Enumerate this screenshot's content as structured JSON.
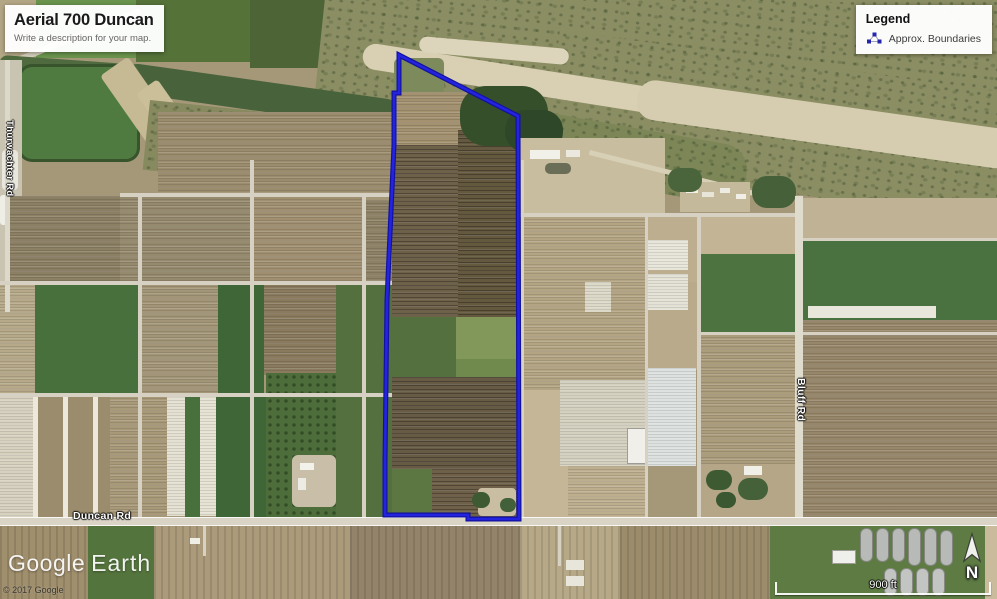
{
  "title_card": {
    "title": "Aerial 700 Duncan",
    "subtitle": "Write a description for your map."
  },
  "legend": {
    "title": "Legend",
    "items": [
      {
        "label": "Approx. Boundaries",
        "icon": "polygon-vertices-icon",
        "icon_color": "#2525ad"
      }
    ]
  },
  "road_labels": [
    {
      "name": "Duncan Rd",
      "orientation": "horizontal"
    },
    {
      "name": "Bluff Rd",
      "orientation": "vertical"
    },
    {
      "name": "Thurwachter Rd",
      "orientation": "vertical"
    }
  ],
  "watermark": {
    "part1": "Google",
    "part2": "Earth"
  },
  "copyright": "© 2017 Google",
  "compass": {
    "label": "N"
  },
  "scale_bar": {
    "label": "900 ft"
  },
  "boundary": {
    "label": "Approx. Boundaries",
    "color_outer": "#12129e",
    "color_inner": "#2424e0",
    "stroke_width_outer": 5,
    "stroke_width_inner": 2.6,
    "path": "M399,55 L518,116 L519,519 L468,519 L468,515 L385,515 L385,462 L387,300 L394,145 L394,93 L399,93 Z"
  },
  "map": {
    "patches": [
      {
        "x": 0,
        "y": 0,
        "w": 997,
        "h": 599,
        "c": "#a59878"
      },
      {
        "x": 0,
        "y": 0,
        "w": 42,
        "h": 64,
        "c": "#b3a685"
      },
      {
        "x": 36,
        "y": 0,
        "w": 100,
        "h": 58,
        "c": "#6a944e"
      },
      {
        "x": 136,
        "y": 0,
        "w": 116,
        "h": 62,
        "c": "#557239"
      },
      {
        "x": 250,
        "y": 0,
        "w": 115,
        "h": 68,
        "c": "#4d6437"
      },
      {
        "x": 0,
        "y": 64,
        "w": 150,
        "h": 6,
        "c": "#d5cfbd",
        "r": -22
      },
      {
        "x": 330,
        "y": -10,
        "w": 680,
        "h": 75,
        "c": "#8b8d63",
        "t": "speckle"
      },
      {
        "x": 330,
        "y": -50,
        "w": 700,
        "h": 150,
        "c": "#8b8d63",
        "t": "speckle",
        "r": 6
      },
      {
        "x": 560,
        "y": 30,
        "w": 470,
        "h": 130,
        "c": "#8b8d63",
        "t": "speckle",
        "r": 8
      },
      {
        "x": 365,
        "y": 42,
        "w": 320,
        "h": 26,
        "c": "#d9d0b4",
        "r": 9,
        "br": 13
      },
      {
        "x": 640,
        "y": 78,
        "w": 380,
        "h": 40,
        "c": "#d6cdb1",
        "r": 8,
        "br": 18
      },
      {
        "x": 420,
        "y": 36,
        "w": 150,
        "h": 16,
        "c": "#ddd5bb",
        "r": 5,
        "br": 8
      },
      {
        "x": 505,
        "y": 105,
        "w": 250,
        "h": 60,
        "c": "#7c8657",
        "t": "speckle",
        "r": 10,
        "br": 26
      },
      {
        "x": 125,
        "y": 62,
        "w": 280,
        "h": 30,
        "c": "#48633b",
        "r": 8,
        "br": 15
      },
      {
        "x": 0,
        "y": 55,
        "w": 140,
        "h": 16,
        "c": "#4e6a3e",
        "r": 4,
        "br": 8
      },
      {
        "x": 18,
        "y": 64,
        "w": 122,
        "h": 98,
        "c": "#4f7a40",
        "t": "edge",
        "br": 14
      },
      {
        "x": 100,
        "y": 76,
        "w": 34,
        "h": 96,
        "c": "#c6ba94",
        "r": -35,
        "br": 4
      },
      {
        "x": 136,
        "y": 94,
        "w": 26,
        "h": 80,
        "c": "#cbbf9a",
        "r": -35,
        "br": 4
      },
      {
        "x": 150,
        "y": 100,
        "w": 110,
        "h": 70,
        "c": "#87895f",
        "t": "speckle",
        "r": 6
      },
      {
        "x": 0,
        "y": 60,
        "w": 22,
        "h": 250,
        "c": "#c9c3b2"
      },
      {
        "x": 2,
        "y": 150,
        "w": 16,
        "h": 40,
        "c": "#e9e7dd",
        "br": 4
      },
      {
        "x": 0,
        "y": 195,
        "w": 14,
        "h": 30,
        "c": "#efeee6",
        "br": 3
      },
      {
        "x": 158,
        "y": 112,
        "w": 234,
        "h": 84,
        "c": "#9b8c6d",
        "t": "rows"
      },
      {
        "x": 6,
        "y": 196,
        "w": 114,
        "h": 87,
        "c": "#8b7f64",
        "t": "rows"
      },
      {
        "x": 120,
        "y": 196,
        "w": 132,
        "h": 87,
        "c": "#968a6e",
        "t": "rows"
      },
      {
        "x": 252,
        "y": 196,
        "w": 112,
        "h": 87,
        "c": "#a09071",
        "t": "rows"
      },
      {
        "x": 364,
        "y": 200,
        "w": 28,
        "h": 83,
        "c": "#8d8266",
        "t": "rows"
      },
      {
        "x": 0,
        "y": 283,
        "w": 35,
        "h": 112,
        "c": "#b5a989",
        "t": "rows"
      },
      {
        "x": 35,
        "y": 283,
        "w": 105,
        "h": 112,
        "c": "#47703c"
      },
      {
        "x": 140,
        "y": 283,
        "w": 78,
        "h": 112,
        "c": "#a39577",
        "t": "rows"
      },
      {
        "x": 218,
        "y": 283,
        "w": 46,
        "h": 112,
        "c": "#3f6636"
      },
      {
        "x": 264,
        "y": 283,
        "w": 72,
        "h": 92,
        "c": "#8a7b5f",
        "t": "rows"
      },
      {
        "x": 336,
        "y": 283,
        "w": 56,
        "h": 235,
        "c": "#54703e"
      },
      {
        "x": 0,
        "y": 395,
        "w": 33,
        "h": 123,
        "c": "#d7d1bf",
        "t": "rows"
      },
      {
        "x": 33,
        "y": 395,
        "w": 77,
        "h": 123,
        "c": "#9a8c6d",
        "t": "strips"
      },
      {
        "x": 110,
        "y": 395,
        "w": 57,
        "h": 123,
        "c": "#a89979",
        "t": "rows"
      },
      {
        "x": 167,
        "y": 397,
        "w": 18,
        "h": 119,
        "c": "#e4e1d2",
        "t": "rows"
      },
      {
        "x": 185,
        "y": 395,
        "w": 15,
        "h": 123,
        "c": "#47703c"
      },
      {
        "x": 200,
        "y": 397,
        "w": 16,
        "h": 119,
        "c": "#e6e3d4",
        "t": "rows"
      },
      {
        "x": 216,
        "y": 395,
        "w": 50,
        "h": 123,
        "c": "#3f6636"
      },
      {
        "x": 266,
        "y": 373,
        "w": 70,
        "h": 145,
        "c": "#4d6d3b",
        "t": "dots"
      },
      {
        "x": 292,
        "y": 455,
        "w": 44,
        "h": 52,
        "c": "#c9bfa8",
        "br": 6
      },
      {
        "x": 300,
        "y": 463,
        "w": 14,
        "h": 7,
        "c": "#f2f1ea"
      },
      {
        "x": 298,
        "y": 478,
        "w": 8,
        "h": 12,
        "c": "#ecece4"
      },
      {
        "x": 394,
        "y": 58,
        "w": 50,
        "h": 36,
        "c": "#7d8a5c",
        "br": 6
      },
      {
        "x": 392,
        "y": 92,
        "w": 128,
        "h": 60,
        "c": "#a3916f",
        "t": "rows"
      },
      {
        "x": 392,
        "y": 145,
        "w": 128,
        "h": 172,
        "c": "#6e614a",
        "t": "rows-dark"
      },
      {
        "x": 458,
        "y": 130,
        "w": 62,
        "h": 187,
        "c": "#64583f",
        "t": "rows-dark"
      },
      {
        "x": 392,
        "y": 317,
        "w": 64,
        "h": 60,
        "c": "#55703f"
      },
      {
        "x": 456,
        "y": 317,
        "w": 64,
        "h": 42,
        "c": "#81985a"
      },
      {
        "x": 456,
        "y": 359,
        "w": 64,
        "h": 18,
        "c": "#6f8a4c"
      },
      {
        "x": 392,
        "y": 377,
        "w": 128,
        "h": 92,
        "c": "#675b45",
        "t": "rows-dark"
      },
      {
        "x": 392,
        "y": 469,
        "w": 40,
        "h": 49,
        "c": "#5d7742"
      },
      {
        "x": 432,
        "y": 469,
        "w": 88,
        "h": 49,
        "c": "#6f6149",
        "t": "rows-dark"
      },
      {
        "x": 478,
        "y": 488,
        "w": 38,
        "h": 28,
        "c": "#c9bda2",
        "br": 4
      },
      {
        "x": 472,
        "y": 492,
        "w": 18,
        "h": 16,
        "c": "#3d5a33",
        "br": 8
      },
      {
        "x": 500,
        "y": 498,
        "w": 16,
        "h": 14,
        "c": "#42603a",
        "br": 7
      },
      {
        "x": 460,
        "y": 86,
        "w": 88,
        "h": 60,
        "c": "#364f2b",
        "br": 26
      },
      {
        "x": 505,
        "y": 110,
        "w": 58,
        "h": 42,
        "c": "#2f4729",
        "br": 20
      },
      {
        "x": 520,
        "y": 138,
        "w": 145,
        "h": 78,
        "c": "#c9bda0"
      },
      {
        "x": 530,
        "y": 150,
        "w": 30,
        "h": 9,
        "c": "#f1f0e9"
      },
      {
        "x": 545,
        "y": 163,
        "w": 26,
        "h": 11,
        "c": "#6b6e57",
        "br": 5
      },
      {
        "x": 566,
        "y": 150,
        "w": 14,
        "h": 7,
        "c": "#ebe9df"
      },
      {
        "x": 590,
        "y": 150,
        "w": 180,
        "h": 5,
        "c": "#d8d0b6",
        "r": 14
      },
      {
        "x": 680,
        "y": 182,
        "w": 70,
        "h": 30,
        "c": "#c5b99c"
      },
      {
        "x": 686,
        "y": 188,
        "w": 12,
        "h": 5,
        "c": "#f2f1ea"
      },
      {
        "x": 702,
        "y": 192,
        "w": 12,
        "h": 5,
        "c": "#e8e5d8"
      },
      {
        "x": 720,
        "y": 188,
        "w": 10,
        "h": 5,
        "c": "#eeece2"
      },
      {
        "x": 736,
        "y": 194,
        "w": 10,
        "h": 5,
        "c": "#f0eee6"
      },
      {
        "x": 752,
        "y": 176,
        "w": 44,
        "h": 32,
        "c": "#46603a",
        "br": 15
      },
      {
        "x": 668,
        "y": 168,
        "w": 34,
        "h": 24,
        "c": "#4a653c",
        "br": 11
      },
      {
        "x": 520,
        "y": 216,
        "w": 125,
        "h": 174,
        "c": "#b3a584",
        "t": "rows"
      },
      {
        "x": 645,
        "y": 216,
        "w": 53,
        "h": 66,
        "c": "#bcae8e"
      },
      {
        "x": 645,
        "y": 282,
        "w": 53,
        "h": 88,
        "c": "#b8aa8a"
      },
      {
        "x": 648,
        "y": 240,
        "w": 40,
        "h": 30,
        "c": "#e8e6da",
        "t": "rows"
      },
      {
        "x": 648,
        "y": 274,
        "w": 40,
        "h": 36,
        "c": "#e4e2d6",
        "t": "rows"
      },
      {
        "x": 585,
        "y": 282,
        "w": 26,
        "h": 30,
        "c": "#dcd9c9",
        "t": "rows"
      },
      {
        "x": 698,
        "y": 216,
        "w": 99,
        "h": 38,
        "c": "#c2b495"
      },
      {
        "x": 698,
        "y": 254,
        "w": 99,
        "h": 80,
        "c": "#4c7340"
      },
      {
        "x": 800,
        "y": 198,
        "w": 197,
        "h": 42,
        "c": "#c0b294"
      },
      {
        "x": 800,
        "y": 240,
        "w": 197,
        "h": 80,
        "c": "#4a7240"
      },
      {
        "x": 808,
        "y": 306,
        "w": 128,
        "h": 12,
        "c": "#e9e7dc"
      },
      {
        "x": 800,
        "y": 320,
        "w": 197,
        "h": 198,
        "c": "#97876a",
        "t": "rows"
      },
      {
        "x": 698,
        "y": 334,
        "w": 99,
        "h": 130,
        "c": "#ab9c7c",
        "t": "rows"
      },
      {
        "x": 520,
        "y": 390,
        "w": 48,
        "h": 128,
        "c": "#c4b697"
      },
      {
        "x": 560,
        "y": 380,
        "w": 86,
        "h": 86,
        "c": "#d5d1c1",
        "t": "rows"
      },
      {
        "x": 627,
        "y": 428,
        "w": 32,
        "h": 36,
        "c": "#f0efe9",
        "t": "bldg"
      },
      {
        "x": 648,
        "y": 368,
        "w": 48,
        "h": 98,
        "c": "#dde1e0",
        "t": "rows"
      },
      {
        "x": 568,
        "y": 466,
        "w": 78,
        "h": 52,
        "c": "#bdae8e",
        "t": "rows"
      },
      {
        "x": 698,
        "y": 464,
        "w": 99,
        "h": 54,
        "c": "#b5a687"
      },
      {
        "x": 706,
        "y": 470,
        "w": 26,
        "h": 20,
        "c": "#3d5a33",
        "br": 10
      },
      {
        "x": 738,
        "y": 478,
        "w": 30,
        "h": 22,
        "c": "#44613a",
        "br": 11
      },
      {
        "x": 716,
        "y": 492,
        "w": 20,
        "h": 16,
        "c": "#3a5731",
        "br": 8
      },
      {
        "x": 744,
        "y": 466,
        "w": 18,
        "h": 9,
        "c": "#f0efe8"
      },
      {
        "x": 5,
        "y": 60,
        "w": 5,
        "h": 252,
        "c": "#dcd8ca"
      },
      {
        "x": 138,
        "y": 196,
        "w": 4,
        "h": 322,
        "c": "#d6d1c2"
      },
      {
        "x": 250,
        "y": 160,
        "w": 4,
        "h": 358,
        "c": "#d6d1c2"
      },
      {
        "x": 362,
        "y": 196,
        "w": 4,
        "h": 322,
        "c": "#d6d1c2"
      },
      {
        "x": 120,
        "y": 193,
        "w": 272,
        "h": 4,
        "c": "#d6d1c2"
      },
      {
        "x": 0,
        "y": 281,
        "w": 392,
        "h": 4,
        "c": "#d6d1c2"
      },
      {
        "x": 0,
        "y": 393,
        "w": 392,
        "h": 4,
        "c": "#d6d1c2"
      },
      {
        "x": 520,
        "y": 213,
        "w": 280,
        "h": 4,
        "c": "#d6d1c2"
      },
      {
        "x": 645,
        "y": 216,
        "w": 3,
        "h": 302,
        "c": "#d6d1c2"
      },
      {
        "x": 697,
        "y": 216,
        "w": 4,
        "h": 302,
        "c": "#d6d1c2"
      },
      {
        "x": 698,
        "y": 332,
        "w": 299,
        "h": 3,
        "c": "#d6d1c2"
      },
      {
        "x": 800,
        "y": 238,
        "w": 197,
        "h": 3,
        "c": "#d6d1c2"
      },
      {
        "x": 795,
        "y": 196,
        "w": 8,
        "h": 330,
        "c": "#e0dccd"
      },
      {
        "x": 521,
        "y": 160,
        "w": 3,
        "h": 358,
        "c": "#d8d3c5"
      },
      {
        "x": 0,
        "y": 517,
        "w": 997,
        "h": 9,
        "c": "#d9d4c6",
        "t": "road-h"
      },
      {
        "x": 0,
        "y": 526,
        "w": 997,
        "h": 73,
        "c": "#a39372"
      },
      {
        "x": 0,
        "y": 526,
        "w": 88,
        "h": 73,
        "c": "#a08f6d",
        "t": "rows-v"
      },
      {
        "x": 88,
        "y": 526,
        "w": 66,
        "h": 73,
        "c": "#54743d"
      },
      {
        "x": 154,
        "y": 526,
        "w": 196,
        "h": 73,
        "c": "#ab9b7a",
        "t": "rows-v"
      },
      {
        "x": 350,
        "y": 526,
        "w": 170,
        "h": 73,
        "c": "#93836a",
        "t": "rows-v"
      },
      {
        "x": 520,
        "y": 526,
        "w": 100,
        "h": 73,
        "c": "#b7a988",
        "t": "rows-v"
      },
      {
        "x": 620,
        "y": 526,
        "w": 150,
        "h": 73,
        "c": "#9c8c6c",
        "t": "rows-v"
      },
      {
        "x": 770,
        "y": 526,
        "w": 227,
        "h": 73,
        "c": "#5d7b43"
      },
      {
        "x": 985,
        "y": 526,
        "w": 12,
        "h": 73,
        "c": "#c9bb9c"
      },
      {
        "x": 860,
        "y": 528,
        "w": 13,
        "h": 34,
        "c": "#b7bab6",
        "t": "bldg",
        "br": 6
      },
      {
        "x": 876,
        "y": 528,
        "w": 13,
        "h": 34,
        "c": "#b7bab6",
        "t": "bldg",
        "br": 6
      },
      {
        "x": 892,
        "y": 528,
        "w": 13,
        "h": 34,
        "c": "#b7bab6",
        "t": "bldg",
        "br": 6
      },
      {
        "x": 908,
        "y": 528,
        "w": 13,
        "h": 38,
        "c": "#b7bab6",
        "t": "bldg",
        "br": 6
      },
      {
        "x": 924,
        "y": 528,
        "w": 13,
        "h": 38,
        "c": "#b7bab6",
        "t": "bldg",
        "br": 6
      },
      {
        "x": 940,
        "y": 530,
        "w": 13,
        "h": 36,
        "c": "#b7bab6",
        "t": "bldg",
        "br": 6
      },
      {
        "x": 884,
        "y": 568,
        "w": 13,
        "h": 28,
        "c": "#c2c5c1",
        "t": "bldg",
        "br": 6
      },
      {
        "x": 900,
        "y": 568,
        "w": 13,
        "h": 28,
        "c": "#c2c5c1",
        "t": "bldg",
        "br": 6
      },
      {
        "x": 916,
        "y": 568,
        "w": 13,
        "h": 28,
        "c": "#c2c5c1",
        "t": "bldg",
        "br": 6
      },
      {
        "x": 932,
        "y": 568,
        "w": 13,
        "h": 28,
        "c": "#c2c5c1",
        "t": "bldg",
        "br": 6
      },
      {
        "x": 832,
        "y": 550,
        "w": 24,
        "h": 14,
        "c": "#eff0ec",
        "t": "bldg"
      },
      {
        "x": 566,
        "y": 560,
        "w": 18,
        "h": 10,
        "c": "#e8e6db"
      },
      {
        "x": 566,
        "y": 576,
        "w": 18,
        "h": 10,
        "c": "#e8e6db"
      },
      {
        "x": 190,
        "y": 538,
        "w": 10,
        "h": 6,
        "c": "#efeee6"
      },
      {
        "x": 203,
        "y": 526,
        "w": 3,
        "h": 30,
        "c": "#d6d1c2"
      },
      {
        "x": 558,
        "y": 526,
        "w": 3,
        "h": 40,
        "c": "#d6d1c2"
      }
    ]
  }
}
